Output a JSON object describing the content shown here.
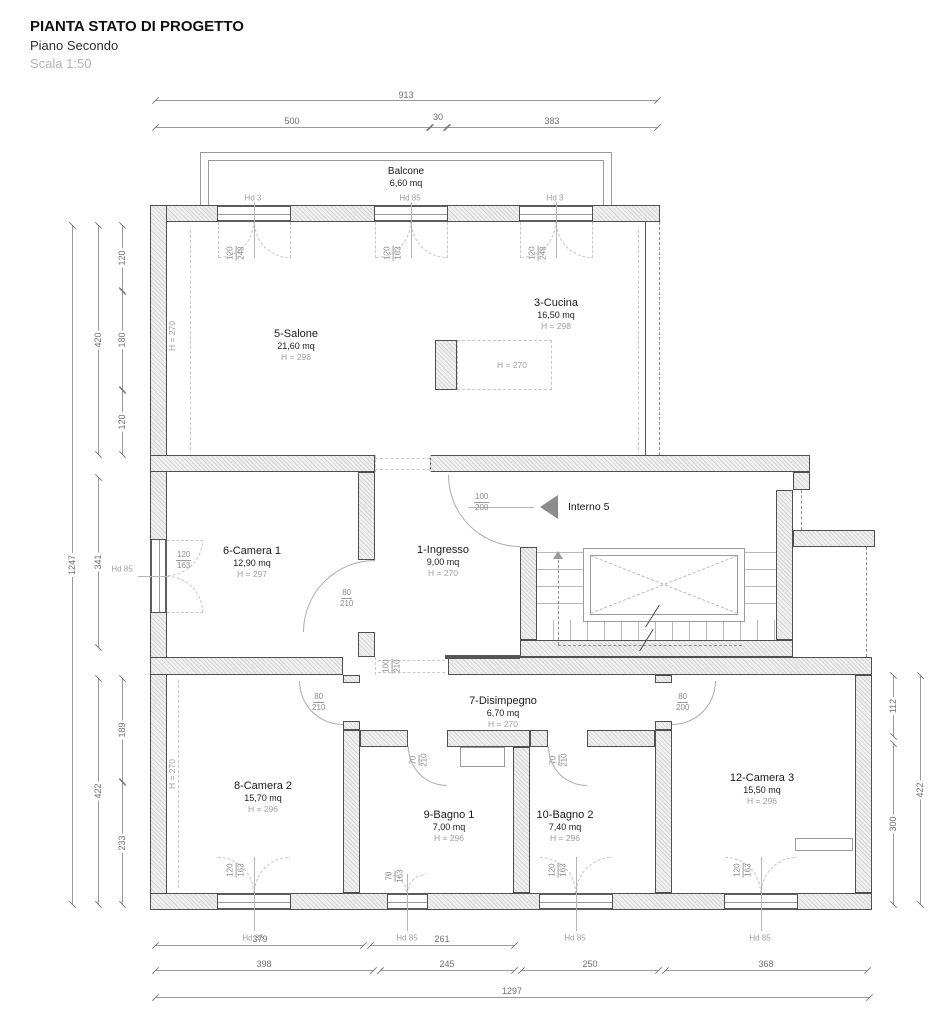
{
  "titleblock": {
    "title": "PIANTA STATO DI PROGETTO",
    "floor": "Piano Secondo",
    "scale": "Scala 1:50"
  },
  "balcony": {
    "name": "Balcone",
    "area": "6,60 mq"
  },
  "rooms": {
    "salone": {
      "name": "5-Salone",
      "area": "21,60 mq",
      "height": "H = 298"
    },
    "cucina": {
      "name": "3-Cucina",
      "area": "16,50 mq",
      "height": "H = 298"
    },
    "camera1": {
      "name": "6-Camera 1",
      "area": "12,90 mq",
      "height": "H = 297"
    },
    "ingresso": {
      "name": "1-Ingresso",
      "area": "9,00 mq",
      "height": "H = 270"
    },
    "disimpegno": {
      "name": "7-Disimpegno",
      "area": "6,70 mq",
      "height": "H = 270"
    },
    "camera2": {
      "name": "8-Camera 2",
      "area": "15,70 mq",
      "height": "H = 296"
    },
    "bagno1": {
      "name": "9-Bagno 1",
      "area": "7,00 mq",
      "height": "H = 296"
    },
    "bagno2": {
      "name": "10-Bagno 2",
      "area": "7,40 mq",
      "height": "H = 296"
    },
    "camera3": {
      "name": "12-Camera 3",
      "area": "15,50 mq",
      "height": "H = 296"
    }
  },
  "annotations": {
    "entrance": "Interno 5",
    "beam_height": "H = 270",
    "wall_height_upper": "H = 270",
    "wall_height_lower": "H = 270"
  },
  "sills": {
    "top1": "Hd 3",
    "top2": "Hd 85",
    "top3": "Hd 3",
    "left": "Hd 85",
    "bottom1": "Hd 85",
    "bottom2": "Hd 85",
    "bottom3": "Hd 85",
    "bottom4": "Hd 85"
  },
  "windows": {
    "balc1": {
      "w": "120",
      "h": "248"
    },
    "balc2": {
      "w": "120",
      "h": "163"
    },
    "balc3": {
      "w": "120",
      "h": "248"
    },
    "camera1": {
      "w": "120",
      "h": "163"
    },
    "camera2": {
      "w": "120",
      "h": "163"
    },
    "bagno1": {
      "w": "70",
      "h": "163"
    },
    "bagno2": {
      "w": "120",
      "h": "163"
    },
    "camera3": {
      "w": "120",
      "h": "163"
    }
  },
  "doors": {
    "camera1": {
      "w": "80",
      "h": "210"
    },
    "entry": {
      "w": "100",
      "h": "200"
    },
    "passage": {
      "w": "100",
      "h": "210"
    },
    "bagno1": {
      "w": "70",
      "h": "210"
    },
    "bagno2": {
      "w": "70",
      "h": "210"
    },
    "camera2": {
      "w": "80",
      "h": "210"
    },
    "camera3": {
      "w": "80",
      "h": "200"
    }
  },
  "dims": {
    "top": {
      "total": "913",
      "a": "500",
      "b": "30",
      "c": "383"
    },
    "left": {
      "total": "1247",
      "upper": "420",
      "mid": "341",
      "lower": "422",
      "u1": "120",
      "u2": "180",
      "u3": "120",
      "l1": "189",
      "l2": "233"
    },
    "right": {
      "total": "422",
      "a": "112",
      "b": "300"
    },
    "bottom": {
      "r1a": "379",
      "r1b": "261",
      "r2a": "398",
      "r2b": "245",
      "r2c": "250",
      "r2d": "368",
      "total": "1297"
    }
  }
}
